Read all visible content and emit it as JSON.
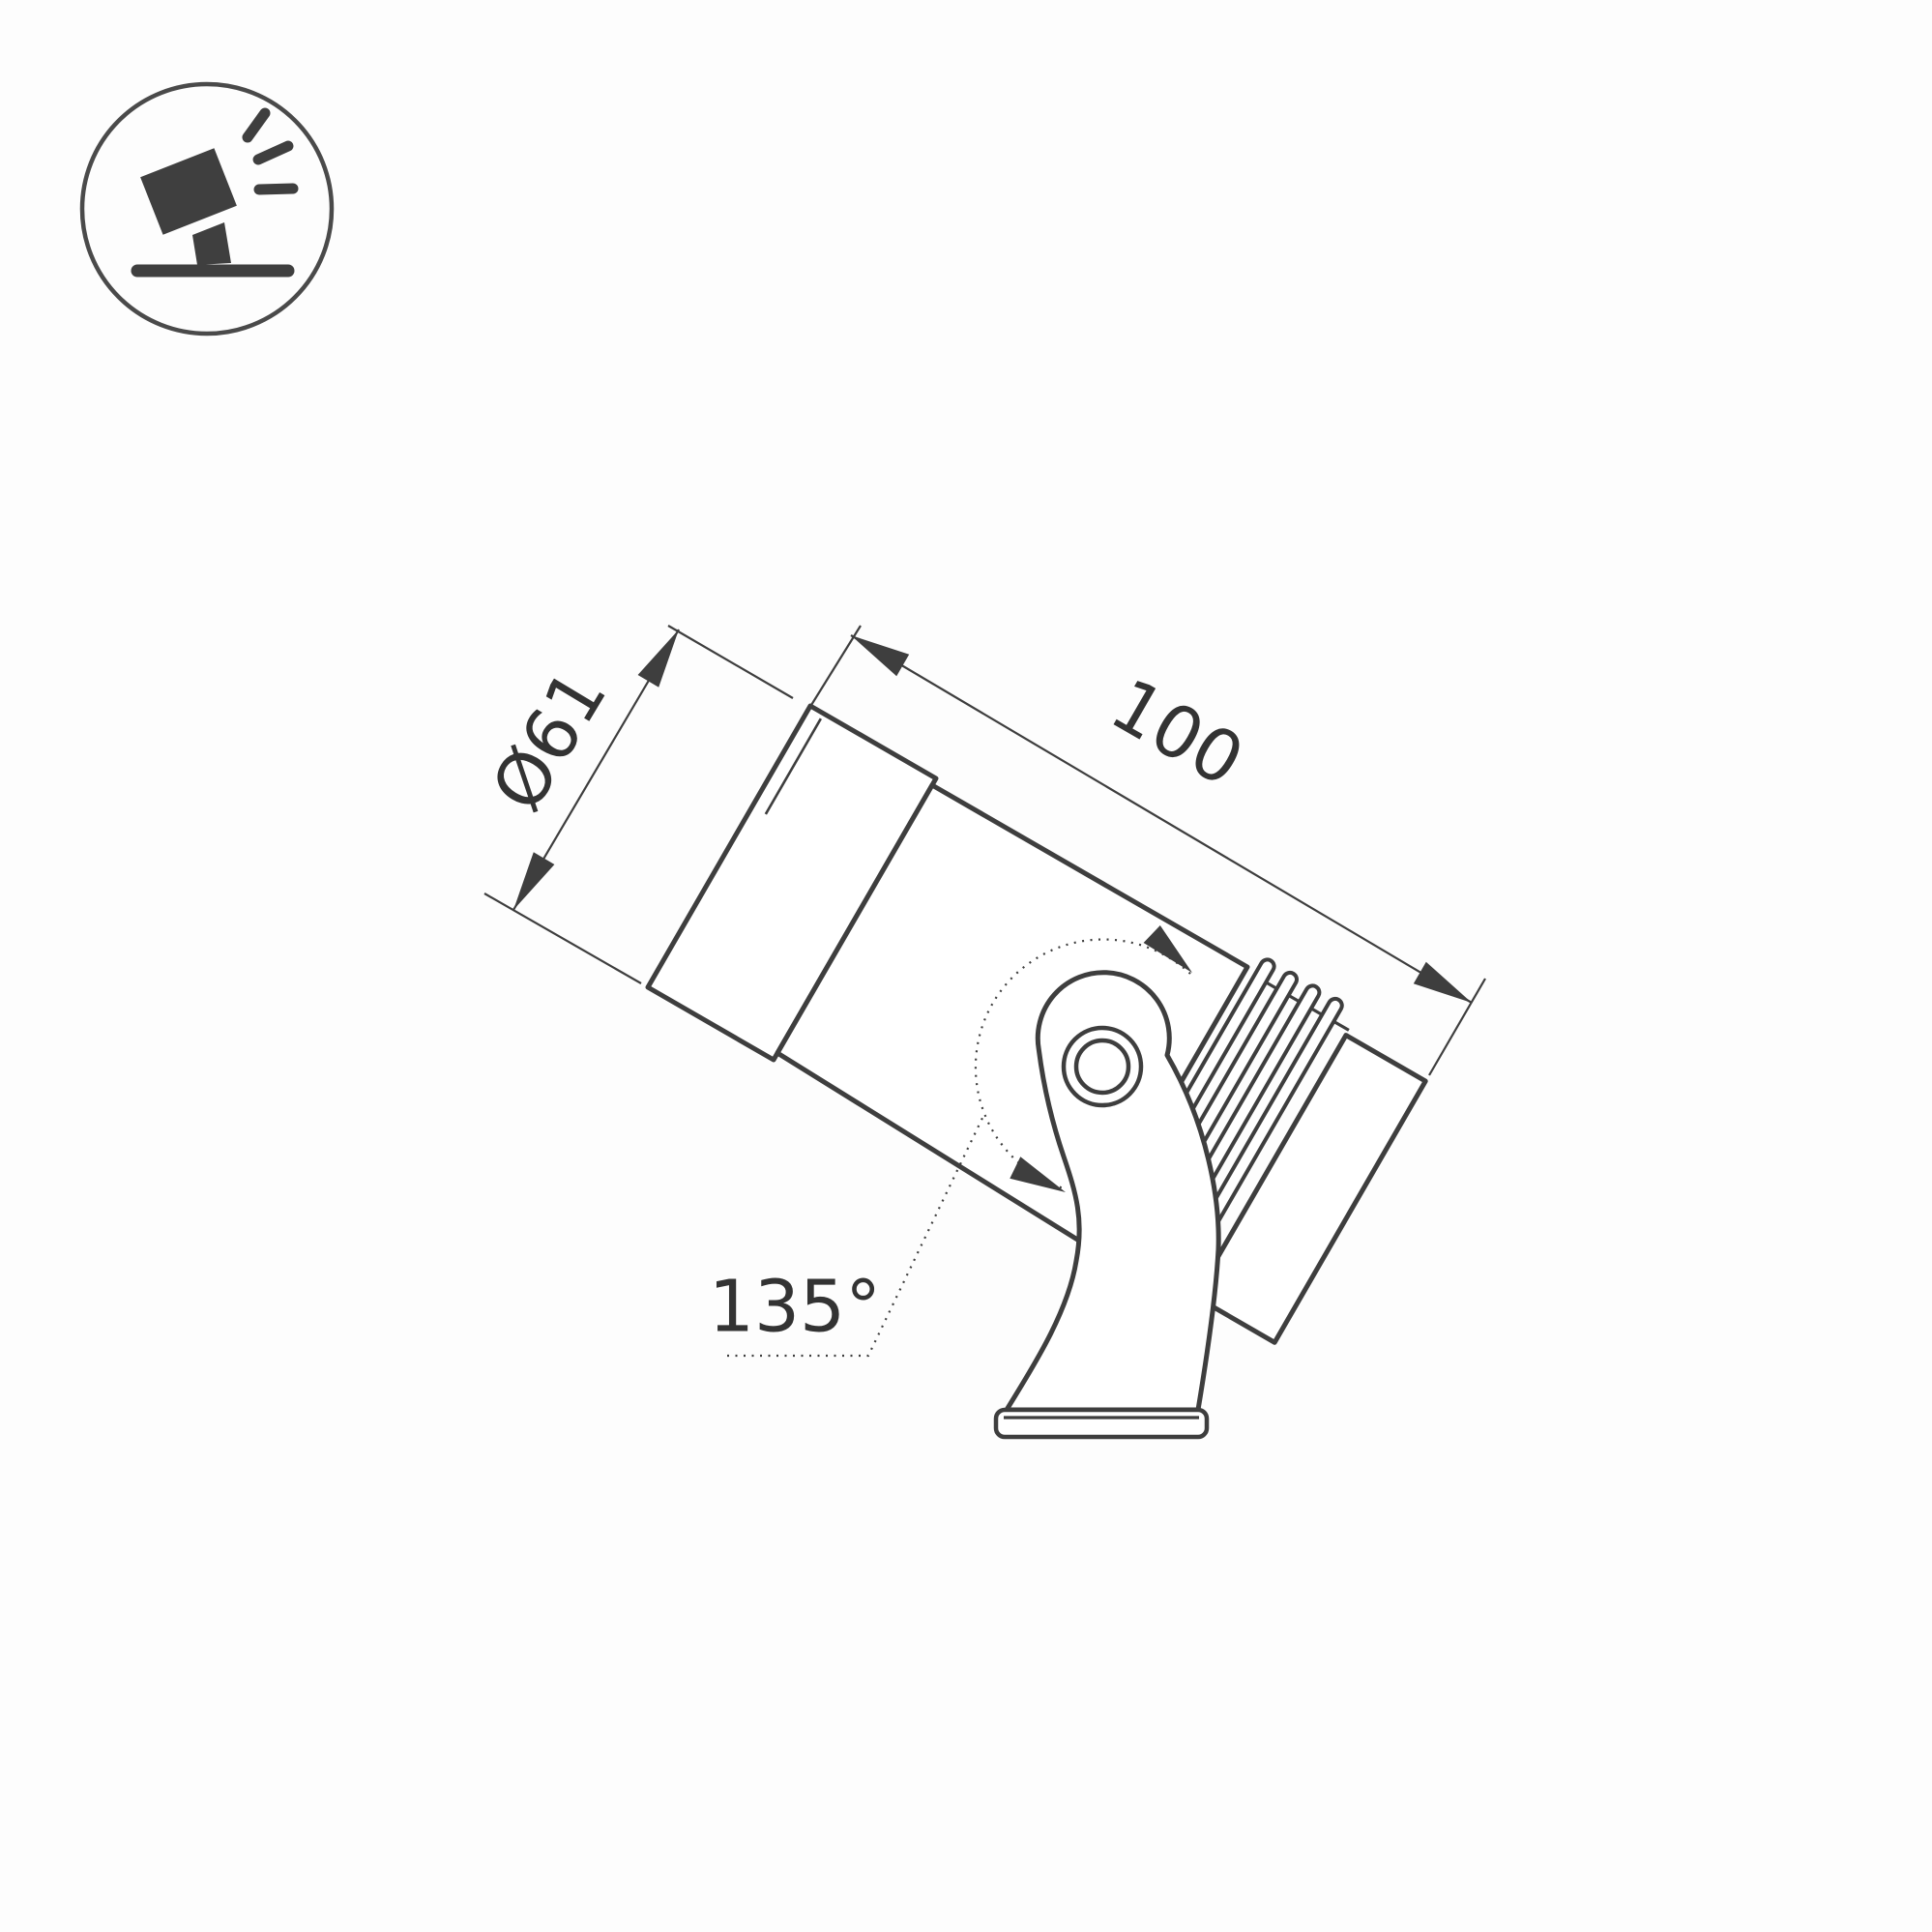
{
  "drawing": {
    "kind": "technical dimension drawing",
    "subject": "adjustable spotlight luminaire on tilting mounting bracket",
    "line_color": "#3e3e3e",
    "fill_color": "#ffffff",
    "background_color": "#fdfdfd"
  },
  "icon": {
    "name": "tilted-spotlight-on-stand",
    "color": "#3f3f3f"
  },
  "dimensions": {
    "diameter": "Ø61",
    "length": "100",
    "angle": "135°"
  }
}
